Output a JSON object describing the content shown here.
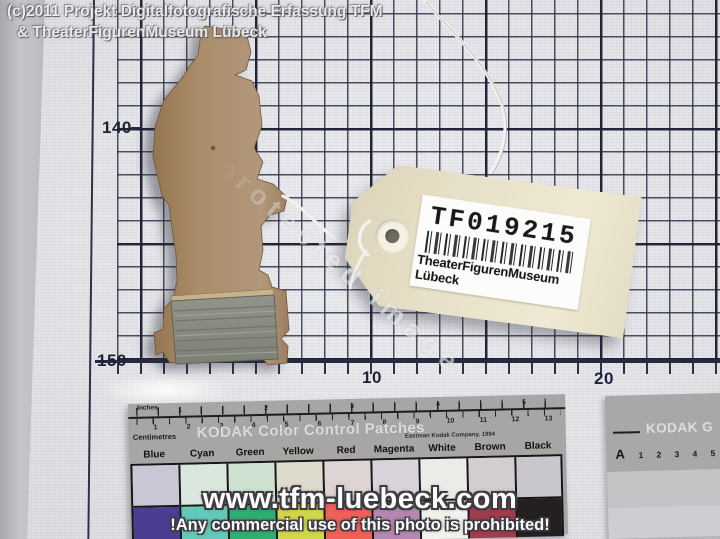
{
  "overlays": {
    "copyright_line1": "(c)2011 Projekt Digitalfotografische Erfassung TFM",
    "copyright_line2": "& TheaterFigurenMuseum Lübeck",
    "website": "www.tfm-luebeck.com",
    "prohibition": "!Any commercial use of this photo is prohibited!",
    "diagonal_watermark": "protected image"
  },
  "graph_paper": {
    "row_labels": [
      "140",
      "150"
    ],
    "col_labels": [
      "10",
      "20"
    ]
  },
  "tag": {
    "id": "TF019215",
    "museum": "TheaterFigurenMuseum Lübeck"
  },
  "color_strip": {
    "brand": "KODAK Color Control Patches",
    "company": "Eastman Kodak Company, 1994",
    "ruler_top_label": "Inches",
    "ruler_bottom_label": "Centimetres",
    "inch_numbers": [
      "1",
      "2",
      "3",
      "4",
      "5"
    ],
    "cm_numbers": [
      "1",
      "2",
      "3",
      "4",
      "5",
      "6",
      "7",
      "8",
      "9",
      "10",
      "11",
      "12",
      "13"
    ],
    "patches": [
      {
        "label": "Blue",
        "tint": "#c9c7d6",
        "color": "#4a3e92"
      },
      {
        "label": "Cyan",
        "tint": "#d9e7df",
        "color": "#63c9b9"
      },
      {
        "label": "Green",
        "tint": "#cfe2d2",
        "color": "#2fae74"
      },
      {
        "label": "Yellow",
        "tint": "#dddbcc",
        "color": "#d2d74a"
      },
      {
        "label": "Red",
        "tint": "#ded4d3",
        "color": "#ef6058"
      },
      {
        "label": "Magenta",
        "tint": "#d9d3dc",
        "color": "#b587b3"
      },
      {
        "label": "White",
        "tint": "#edebe7",
        "color": "#f3f1ec"
      },
      {
        "label": "Brown",
        "tint": "#d3cdd1",
        "color": "#a23c4c"
      },
      {
        "label": "Black",
        "tint": "#c9c7cb",
        "color": "#242021"
      }
    ]
  },
  "gray_strip": {
    "brand": "KODAK G",
    "index_row": [
      "A",
      "1",
      "2",
      "3",
      "4",
      "5"
    ]
  }
}
